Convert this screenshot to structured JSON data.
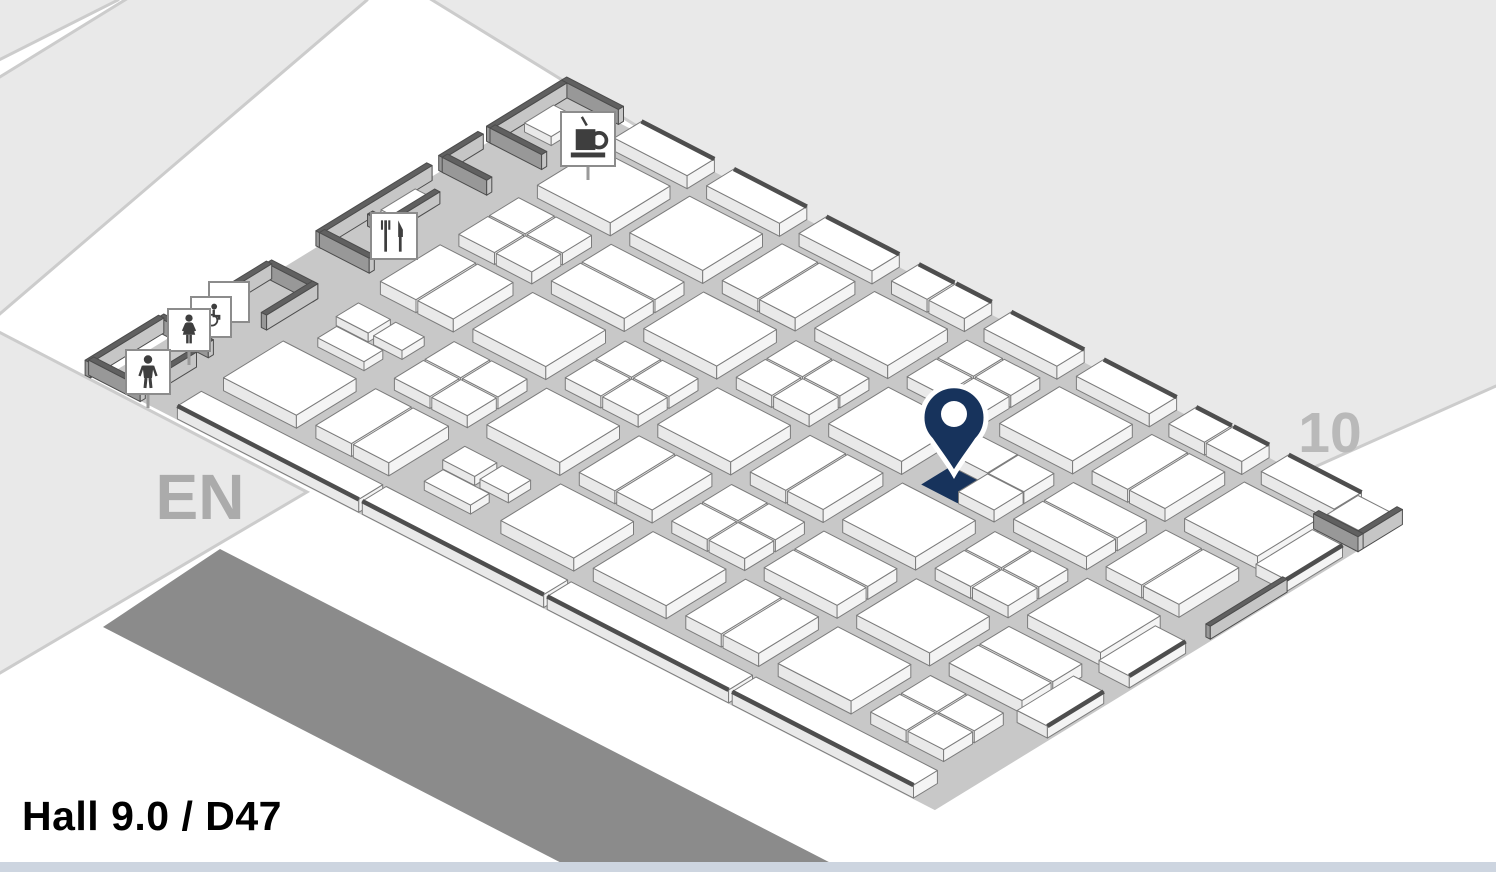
{
  "title": {
    "text": "Hall 9.0 / D47"
  },
  "map": {
    "colors": {
      "background": "#ffffff",
      "adjacent_fill": "#e9e9e9",
      "adjacent_stroke": "#cccccc",
      "band": "#8b8b8b",
      "floor": "#c8c8c8",
      "booth_top": "#ffffff",
      "booth_side_left": "#e9e9e9",
      "booth_side_right": "#f4f4f4",
      "booth_stroke": "#7c7c7c",
      "wall_top": "#606060",
      "wall_side_left": "#989898",
      "wall_side_right": "#c6c6c6",
      "wall_stroke": "#4c4c4c",
      "dark_edge": "#4e4e4e",
      "accent_navy": "#17335c",
      "icon_box_stroke": "#8c8c8c",
      "icon_glyph": "#3e3e3e",
      "bottom_bar": "#cdd5e0"
    },
    "iso": {
      "origin": [
        565,
        95
      ],
      "e1": [
        0.889,
        0.458
      ],
      "e2": [
        -0.853,
        0.523
      ],
      "extent": [
        939,
        545
      ]
    },
    "bg_shapes": [
      {
        "name": "adjacent-area-top-left-far",
        "points": "-5,-5 118,-5 118,0 -5,62"
      },
      {
        "name": "adjacent-area-top-left",
        "points": "133,-5 367,-5 367,0 -5,318 -5,80"
      },
      {
        "name": "entrance-area-EN",
        "points": "-5,330 307,492 -5,676"
      },
      {
        "name": "adjacent-hall-10",
        "points": "424,-5 1501,-5 1501,386 1496,386 1243,499"
      }
    ],
    "dark_band_points": "220,549 858,877 612,889 103,627",
    "labels": [
      {
        "text": "EN",
        "x": 200,
        "y": 519,
        "size": 64,
        "color": "#ababab",
        "name": "entrance-label"
      },
      {
        "text": "10",
        "x": 1330,
        "y": 452,
        "size": 57,
        "color": "#b9b9b9",
        "name": "adjacent-hall-label"
      }
    ],
    "grid": {
      "col_u": [
        86,
        190,
        294,
        398,
        502,
        606,
        710,
        814
      ],
      "row_v": [
        52,
        144,
        236,
        328,
        420
      ],
      "island_w": 82,
      "island_d": 70,
      "pattern": [
        "SSVSQSVS",
        "QHSQSNHV",
        "VSQSVSQS",
        "TQSVQHSH",
        "SVTSSVSQ"
      ]
    },
    "top_edge_row": {
      "v": 0,
      "d": 32,
      "h": 13,
      "split_cols": [
        3,
        6
      ]
    },
    "bottom_edge_booths": [
      {
        "u": 86,
        "v": 516,
        "w": 204,
        "d": 28,
        "h": 13
      },
      {
        "u": 294,
        "v": 516,
        "w": 204,
        "d": 28,
        "h": 13
      },
      {
        "u": 502,
        "v": 516,
        "w": 204,
        "d": 28,
        "h": 13
      },
      {
        "u": 710,
        "v": 516,
        "w": 204,
        "d": 28,
        "h": 13
      }
    ],
    "right_edge_booths": [
      {
        "u": 902,
        "v": 64,
        "w": 34,
        "d": 66,
        "h": 12
      },
      {
        "u": 902,
        "v": 248,
        "w": 34,
        "d": 66,
        "h": 12
      },
      {
        "u": 902,
        "v": 344,
        "w": 34,
        "d": 66,
        "h": 12
      }
    ],
    "walls": [
      {
        "u": -2,
        "v": -4,
        "w": 64,
        "d": 6,
        "h": 15
      },
      {
        "u": -2,
        "v": 2,
        "w": 6,
        "d": 88,
        "h": 15
      },
      {
        "u": 2,
        "v": 84,
        "w": 58,
        "d": 6,
        "h": 15
      },
      {
        "u": -2,
        "v": 100,
        "w": 6,
        "d": 46,
        "h": 15
      },
      {
        "u": 2,
        "v": 140,
        "w": 50,
        "d": 6,
        "h": 15
      },
      {
        "u": -2,
        "v": 160,
        "w": 6,
        "d": 130,
        "h": 15
      },
      {
        "u": 2,
        "v": 284,
        "w": 56,
        "d": 6,
        "h": 15
      },
      {
        "u": 26,
        "v": 180,
        "w": 6,
        "d": 60,
        "h": 12
      },
      {
        "u": 10,
        "v": 236,
        "w": 40,
        "d": 6,
        "h": 12
      },
      {
        "u": -2,
        "v": 348,
        "w": 6,
        "d": 80,
        "h": 15
      },
      {
        "u": 0,
        "v": 344,
        "w": 52,
        "d": 6,
        "h": 15
      },
      {
        "u": 46,
        "v": 344,
        "w": 6,
        "d": 60,
        "h": 15
      },
      {
        "u": -14,
        "v": 462,
        "w": 6,
        "d": 86,
        "h": 15
      },
      {
        "u": -12,
        "v": 458,
        "w": 56,
        "d": 6,
        "h": 15
      },
      {
        "u": -12,
        "v": 540,
        "w": 58,
        "d": 6,
        "h": 15
      },
      {
        "u": 40,
        "v": 480,
        "w": 6,
        "d": 40,
        "h": 15
      },
      {
        "u": 934,
        "v": -2,
        "w": 6,
        "d": 52,
        "h": 15
      },
      {
        "u": 890,
        "v": 44,
        "w": 50,
        "d": 6,
        "h": 15
      },
      {
        "u": 932,
        "v": 130,
        "w": 5,
        "d": 90,
        "h": 13
      }
    ],
    "service_booths": [
      {
        "u": 12,
        "v": 26,
        "w": 30,
        "d": 34,
        "h": 9
      },
      {
        "u": 10,
        "v": 186,
        "w": 22,
        "d": 40,
        "h": 8
      },
      {
        "u": 894,
        "v": 2,
        "w": 36,
        "d": 36,
        "h": 10
      }
    ],
    "highlight_booth": {
      "u": 606,
      "v": 179,
      "w": 41,
      "d": 35
    },
    "pin": {
      "tip_x": 954,
      "tip_y": 474
    },
    "icons": [
      {
        "name": "coffee-icon",
        "glyph": "coffee",
        "x": 588,
        "y": 139,
        "size": 54,
        "stand": true
      },
      {
        "name": "restaurant-icon",
        "glyph": "restaurant",
        "x": 394,
        "y": 236,
        "size": 46,
        "stand": false
      },
      {
        "name": "blank-sign-icon",
        "glyph": "blank",
        "x": 229,
        "y": 302,
        "size": 40,
        "stand": false
      },
      {
        "name": "accessible-restroom-icon",
        "glyph": "accessible",
        "x": 211,
        "y": 317,
        "size": 40,
        "stand": false
      },
      {
        "name": "womens-restroom-icon",
        "glyph": "women",
        "x": 189,
        "y": 330,
        "size": 42,
        "stand": true
      },
      {
        "name": "mens-restroom-icon",
        "glyph": "men",
        "x": 148,
        "y": 372,
        "size": 44,
        "stand": true
      }
    ]
  }
}
